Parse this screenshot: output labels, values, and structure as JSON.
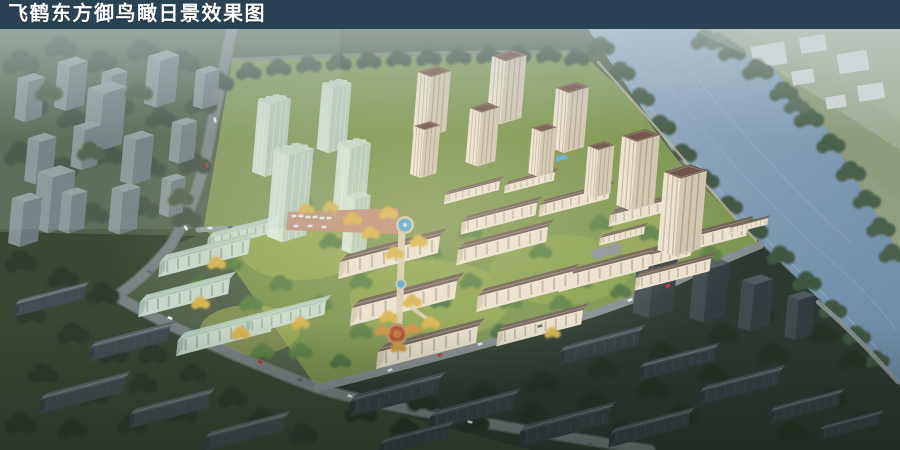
{
  "header": {
    "title": "飞鹤东方御鸟瞰日景效果图",
    "background_color": "#2b4154",
    "text_color": "#ffffff"
  },
  "scene": {
    "description": "Aerial daytime rendering of a riverside residential development: cream high-rise towers, translucent glass massing blocks, fanned mid-rise rows, a central landscape axis with round pools and plazas, surrounded by darker context city blocks and a blue river",
    "palette": {
      "haze": "#cdd6da",
      "river": "#7f9cb5",
      "riverside_trees": "#42563f",
      "site_lawn": "#7d9450",
      "bright_tree": "#5d8044",
      "autumn_tree": "#d6b14c",
      "tower_facade": "#ece3cf",
      "tower_roof": "#6b4c40",
      "glass_massing": "#dce9e1",
      "context_building": "#8e9a9e",
      "dark_context": "#2c3830",
      "road": "#7b8285",
      "entry_plaza": "#c08a70",
      "pool": "#4fa6cc"
    }
  }
}
